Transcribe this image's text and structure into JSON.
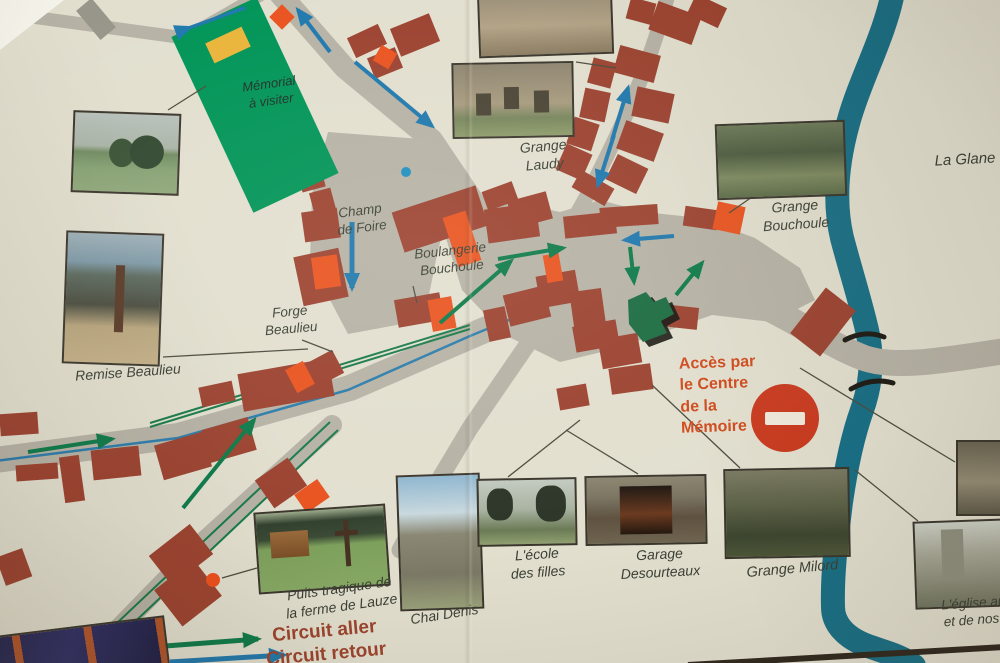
{
  "map_labels": {
    "memorial": "Mémorial\nà visiter",
    "champ_de_foire": "Champ\nde Foire",
    "grange_laudy": "Grange\nLaudy",
    "la_glane": "La Glane",
    "grange_bouchoule": "Grange\nBouchoule",
    "boulangerie_bouchoule": "Boulangerie\nBouchoule",
    "forge_beaulieu": "Forge\nBeaulieu",
    "remise_beaulieu": "Remise Beaulieu",
    "acces_centre_memoire": "Accès par\nle Centre\nde la\nMémoire",
    "ecole_des_filles": "L'école\ndes filles",
    "garage_desourteaux": "Garage\nDesourteaux",
    "grange_milord": "Grange Milord",
    "puits_tragique": "Puits tragique de\nla ferme de Lauze",
    "chai_denis": "Chai Denis",
    "eglise_partial": "L'église autr\net de nos jo"
  },
  "legend": {
    "circuit_aller": "Circuit aller",
    "circuit_retour": "Circuit retour"
  },
  "colors": {
    "background_cream": "#e2dfcf",
    "road_gray": "#b6b2a5",
    "building_red": "#9c4230",
    "building_highlight_orange": "#e9531f",
    "memorial_green": "#009457",
    "memorial_marker_yellow": "#e9b43a",
    "church_green": "#1b6b40",
    "river_teal": "#176e85",
    "circuit_aller_green": "#0d7a4a",
    "circuit_retour_blue": "#2b7cab",
    "no_entry_red": "#c93a1f",
    "label_dark": "#3a3f33",
    "acces_text_orange": "#d04a1c",
    "legend_text_brick": "#9c432d"
  }
}
